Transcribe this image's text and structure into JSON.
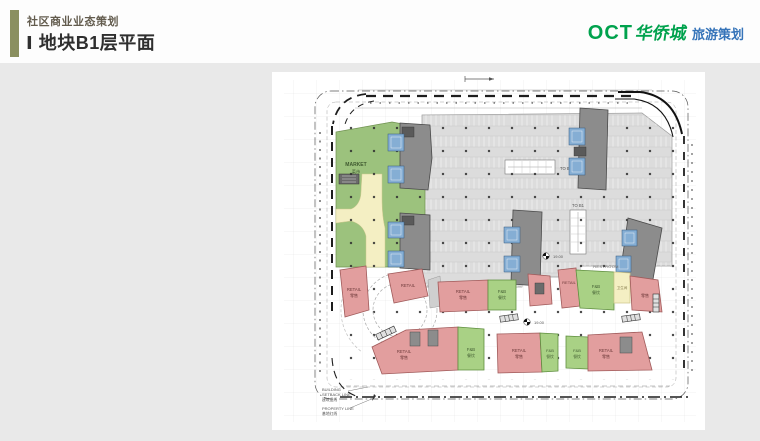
{
  "header": {
    "eyebrow": "社区商业业态策划",
    "title": "Ⅰ 地块B1层平面"
  },
  "logo": {
    "oct": "OCT",
    "brand": "华侨城",
    "suffix": "旅游策划",
    "green": "#00a24d",
    "blue": "#3674b9"
  },
  "plan": {
    "labels": {
      "market": "MARKET",
      "market_cn": "菜市",
      "retail": "RETAIL",
      "retail_cn": "零售",
      "fnb": "F&B",
      "fnb_cn": "餐饮",
      "to_b1": "TO B1",
      "restroom": "RESTROOM",
      "restroom_cn": "卫生间",
      "elevation": "19.00",
      "setback_1": "BUILDING",
      "setback_2": "SETBACK LINE",
      "setback_cn": "建筑退线",
      "property_1": "PROPERTY LINE",
      "property_cn": "基地红线"
    },
    "zone_colors": {
      "market": "#9cc27d",
      "retail": "#e29e9e",
      "fnb": "#a9d185",
      "walkway": "#f4efc3",
      "parking": "#dcdcdc",
      "tower": "#8c8c8c",
      "core": "#85aed4",
      "accent_bar": "#8a8f5f"
    }
  }
}
